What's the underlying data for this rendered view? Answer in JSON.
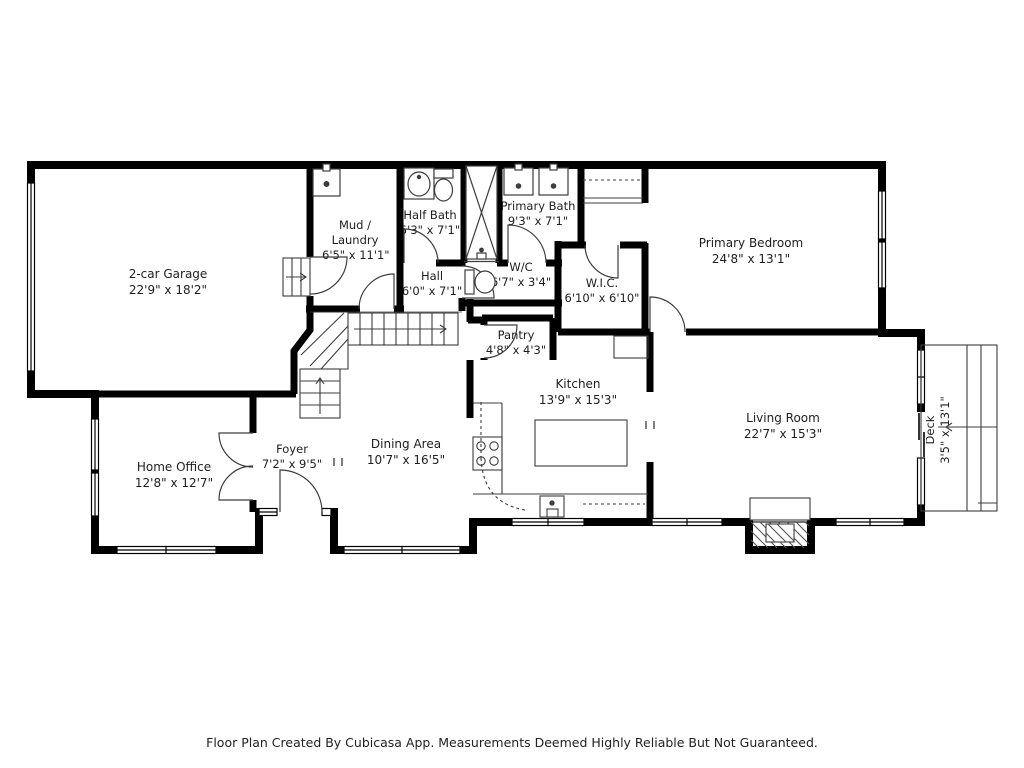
{
  "colors": {
    "wall": "#000000",
    "text": "#1e1e1e",
    "background": "#ffffff",
    "fixture_line": "#3d3d3d"
  },
  "rooms": [
    {
      "id": "garage",
      "name": "2-car Garage",
      "dims": "22'9\" x 18'2\""
    },
    {
      "id": "mud-laundry",
      "name": "Mud / Laundry",
      "dims": "6'5\" x 11'1\""
    },
    {
      "id": "half-bath",
      "name": "Half Bath",
      "dims": "5'3\" x 7'1\""
    },
    {
      "id": "primary-bath",
      "name": "Primary Bath",
      "dims": "9'3\" x 7'1\""
    },
    {
      "id": "primary-bedroom",
      "name": "Primary Bedroom",
      "dims": "24'8\" x 13'1\""
    },
    {
      "id": "hall",
      "name": "Hall",
      "dims": "6'0\" x 7'1\""
    },
    {
      "id": "wc",
      "name": "W/C",
      "dims": "6'7\" x 3'4\""
    },
    {
      "id": "wic",
      "name": "W.I.C.",
      "dims": "6'10\" x 6'10\""
    },
    {
      "id": "pantry",
      "name": "Pantry",
      "dims": "4'8\" x 4'3\""
    },
    {
      "id": "kitchen",
      "name": "Kitchen",
      "dims": "13'9\" x 15'3\""
    },
    {
      "id": "dining-area",
      "name": "Dining Area",
      "dims": "10'7\" x 16'5\""
    },
    {
      "id": "foyer",
      "name": "Foyer",
      "dims": "7'2\" x 9'5\""
    },
    {
      "id": "home-office",
      "name": "Home Office",
      "dims": "12'8\" x 12'7\""
    },
    {
      "id": "living-room",
      "name": "Living Room",
      "dims": "22'7\" x 15'3\""
    },
    {
      "id": "deck",
      "name": "Deck",
      "dims": "3'5\" x 13'1\""
    }
  ],
  "footer": {
    "caption": "Floor Plan Created By Cubicasa App. Measurements Deemed Highly Reliable But Not Guaranteed."
  }
}
